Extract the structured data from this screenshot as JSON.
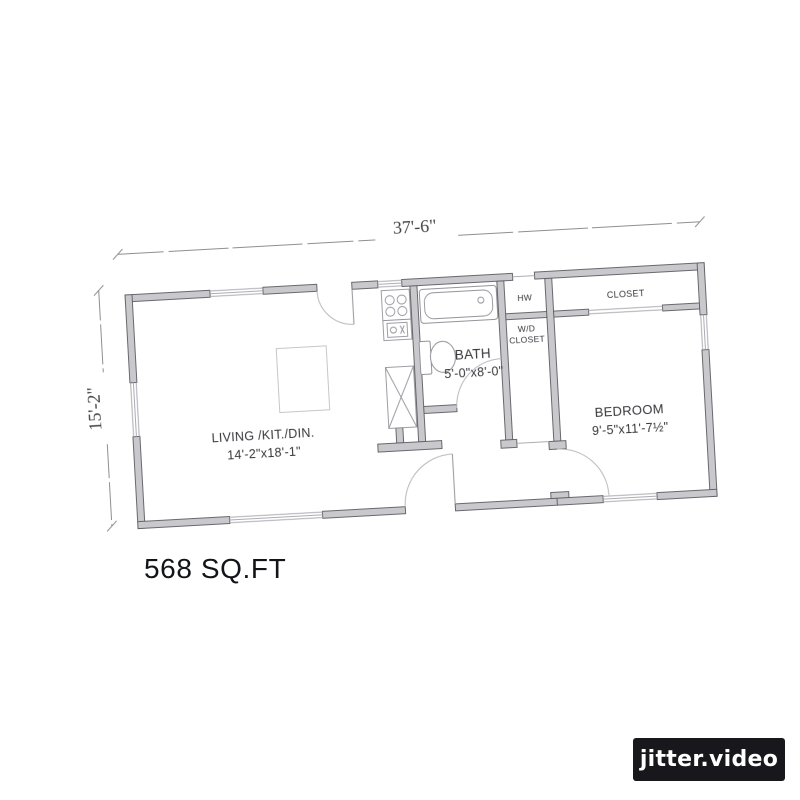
{
  "plan": {
    "dim_width": "37'-6\"",
    "dim_height": "15'-2\"",
    "area_label": "568 SQ.FT",
    "rooms": {
      "living": {
        "name": "LIVING /KIT./DIN.",
        "size": "14'-2\"x18'-1\""
      },
      "bath": {
        "name": "BATH",
        "size": "5'-0\"x8'-0\""
      },
      "bedroom": {
        "name": "BEDROOM",
        "size": "9'-5\"x11'-7½\""
      },
      "closet": {
        "name": "CLOSET"
      },
      "wd_closet": {
        "line1": "W/D",
        "line2": "CLOSET"
      },
      "water_heater": {
        "name": "HW"
      }
    }
  },
  "watermark": {
    "label": "jitter.video"
  },
  "colors": {
    "wall_fill": "#c7c7cb",
    "wall_stroke": "#55555a",
    "badge_bg": "#17171c",
    "badge_text": "#ffffff"
  }
}
